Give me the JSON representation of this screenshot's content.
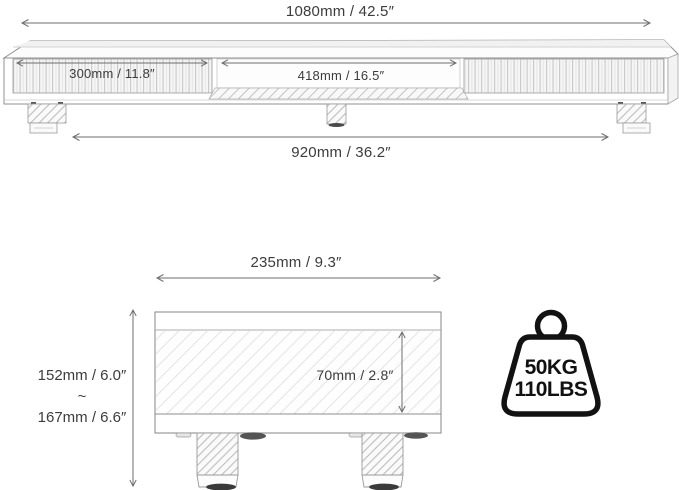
{
  "front_view": {
    "total_width_label": "1080mm / 42.5″",
    "left_door_label": "300mm / 11.8″",
    "open_shelf_label": "418mm / 16.5″",
    "leg_span_label": "920mm / 36.2″"
  },
  "side_view": {
    "depth_label": "235mm / 9.3″",
    "inner_height_label": "70mm / 2.8″",
    "height_min_label": "152mm / 6.0″",
    "height_range_separator": "~",
    "height_max_label": "167mm / 6.6″"
  },
  "weight_capacity": {
    "kg_label": "50KG",
    "lbs_label": "110LBS"
  },
  "colors": {
    "outline": "#919191",
    "dimension_line": "#6e6e6e",
    "text": "#3c3c3c",
    "icon_stroke": "#121212",
    "background": "#ffffff"
  }
}
